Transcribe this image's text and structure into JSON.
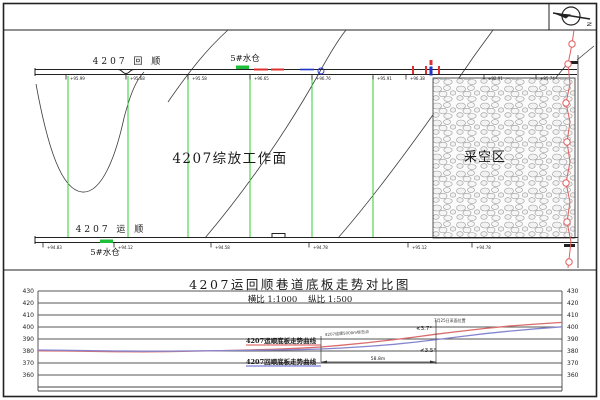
{
  "page": {
    "compass_label": "N"
  },
  "colors": {
    "survey_green": "#2ed22e",
    "label_blue": "#1515cc",
    "mark_red": "#e03030",
    "red_curve": "#d96b6b",
    "blue_curve": "#8585cf",
    "borehole_red": "#e06060"
  },
  "plan": {
    "upper_tunnel_label": "4207 回 顺",
    "lower_tunnel_label": "4207 运 顺",
    "upper_sump_label": "5#水仓",
    "lower_sump_label": "5#水仓",
    "face_label": "4207综放工作面",
    "goaf_label": "采空区",
    "upper_stations": [
      {
        "x": 70,
        "v": "+95.99"
      },
      {
        "x": 130,
        "v": "+95.68"
      },
      {
        "x": 192,
        "v": "+95.58"
      },
      {
        "x": 254,
        "v": "+96.65"
      },
      {
        "x": 316,
        "v": "+96.76"
      },
      {
        "x": 377,
        "v": "+95.91"
      },
      {
        "x": 410,
        "v": "+96.38"
      },
      {
        "x": 488,
        "v": "+92.91"
      },
      {
        "x": 540,
        "v": "+95.74"
      }
    ],
    "lower_stations": [
      {
        "x": 47,
        "v": "+94.83"
      },
      {
        "x": 118,
        "v": "+94.12"
      },
      {
        "x": 215,
        "v": "+94.58"
      },
      {
        "x": 313,
        "v": "+94.78"
      },
      {
        "x": 412,
        "v": "+95.12"
      },
      {
        "x": 476,
        "v": "+94.78"
      }
    ]
  },
  "chart": {
    "title": "4207运回顺巷道底板走势对比图",
    "subtitle": "横比 1:1000    纵比 1:500",
    "red_label": "4207运顺底板走势曲线",
    "blue_label": "4207回顺底板走势曲线",
    "ann_marker": "4207运顺5000m标志点",
    "ann_face": "7月25日采面位置",
    "angle_top": "≮3.7°",
    "angle_bottom": "≮3.5°",
    "dim_label": "58.8m"
  },
  "chart_data": {
    "type": "line",
    "title": "4207运回顺巷道底板走势对比图",
    "scale_note": "横比 1:1000 纵比 1:500",
    "ylabel": "底板标高",
    "ylim": [
      360,
      430
    ],
    "yticks": [
      430,
      420,
      410,
      400,
      390,
      380,
      370,
      360
    ],
    "grid": true,
    "series": [
      {
        "name": "4207运顺底板走势曲线",
        "color": "#d96b6b",
        "points": [
          [
            0,
            380.2
          ],
          [
            0.05,
            380.0
          ],
          [
            0.1,
            379.7
          ],
          [
            0.15,
            379.4
          ],
          [
            0.2,
            379.3
          ],
          [
            0.25,
            379.5
          ],
          [
            0.3,
            379.9
          ],
          [
            0.35,
            380.3
          ],
          [
            0.4,
            380.8
          ],
          [
            0.45,
            381.4
          ],
          [
            0.5,
            382.3
          ],
          [
            0.54,
            383.3
          ],
          [
            0.58,
            384.8
          ],
          [
            0.63,
            387.0
          ],
          [
            0.68,
            389.5
          ],
          [
            0.72,
            391.7
          ],
          [
            0.76,
            394.0
          ],
          [
            0.8,
            396.2
          ],
          [
            0.85,
            398.7
          ],
          [
            0.9,
            400.8
          ],
          [
            0.95,
            402.4
          ],
          [
            1,
            403.8
          ]
        ]
      },
      {
        "name": "4207回顺底板走势曲线",
        "color": "#8585cf",
        "points": [
          [
            0,
            380.8
          ],
          [
            0.05,
            380.6
          ],
          [
            0.1,
            380.3
          ],
          [
            0.15,
            380.0
          ],
          [
            0.2,
            379.8
          ],
          [
            0.25,
            379.9
          ],
          [
            0.3,
            380.1
          ],
          [
            0.35,
            380.3
          ],
          [
            0.4,
            380.5
          ],
          [
            0.45,
            380.8
          ],
          [
            0.5,
            381.2
          ],
          [
            0.54,
            381.7
          ],
          [
            0.58,
            382.5
          ],
          [
            0.63,
            383.8
          ],
          [
            0.68,
            385.6
          ],
          [
            0.72,
            387.4
          ],
          [
            0.76,
            389.5
          ],
          [
            0.8,
            391.7
          ],
          [
            0.85,
            394.3
          ],
          [
            0.9,
            396.6
          ],
          [
            0.95,
            398.5
          ],
          [
            1,
            400.2
          ]
        ]
      }
    ]
  }
}
